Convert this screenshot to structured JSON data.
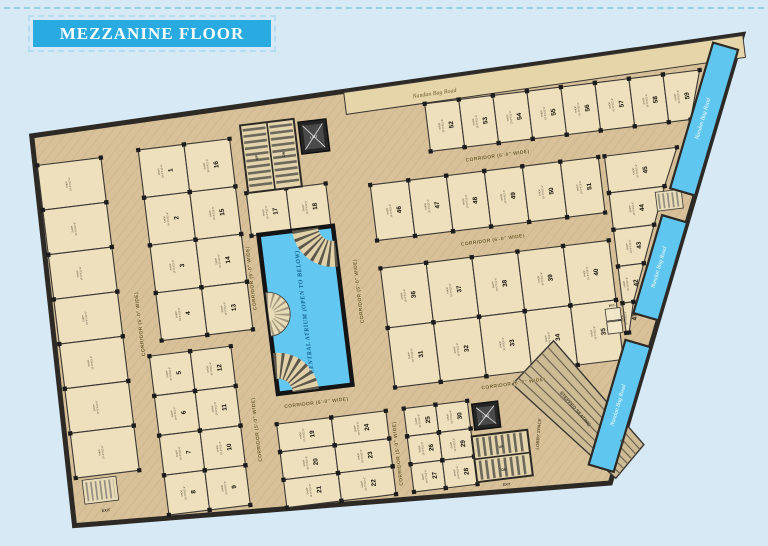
{
  "banner": {
    "title": "MEZZANINE FLOOR",
    "bg": "#29abe2"
  },
  "plan": {
    "colors": {
      "floor": "#d8c198",
      "shop": "#eee0bc",
      "wall": "#2d2a26",
      "water": "#62c8f2",
      "road": "#5fc6ef"
    },
    "atrium": {
      "label": "CENTRAL ATRIUM (OPEN TO BELOW)"
    },
    "roads": {
      "label": "Nandan Bag Road"
    },
    "stairs": {
      "up_label": "UP",
      "dn_label": "DN"
    },
    "lift_label": "LIFT",
    "wc_label": "W.C.",
    "shop_text": {
      "line1": "SHOP",
      "dims": "10'-0\"X12'-6\""
    },
    "corridors": [
      {
        "label": "CORRIDOR (6'-0\" WIDE)",
        "x": 460,
        "y": 92,
        "r": -1
      },
      {
        "label": "CORRIDOR (6'-0\" WIDE)",
        "x": 445,
        "y": 175,
        "r": -1
      },
      {
        "label": "CORRIDOR (6'-0\" WIDE)",
        "x": 448,
        "y": 320,
        "r": -1
      },
      {
        "label": "CORRIDOR (6'-0\" WIDE)",
        "x": 250,
        "y": 315,
        "r": 0
      },
      {
        "label": "CORRIDOR (6'-0\" WIDE)",
        "x": 307,
        "y": 208,
        "r": -90
      },
      {
        "label": "CORRIDOR (5'-0\" WIDE)",
        "x": 86,
        "y": 214,
        "r": -90
      },
      {
        "label": "CORRIDOR (6'-0\" WIDE)",
        "x": 202,
        "y": 182,
        "r": -90
      },
      {
        "label": "CORRIDOR (5'-0\" WIDE)",
        "x": 189,
        "y": 333,
        "r": -90
      },
      {
        "label": "CORRIDOR (5'-0\" WIDE)",
        "x": 326,
        "y": 374,
        "r": -90
      }
    ],
    "road_segments": [
      {
        "pts": "711.6,14.7 651.2,154.1 627.3,143.8 687.7,4.4",
        "lx": 669.6,
        "ly": 79.3,
        "r": -66.6
      },
      {
        "pts": "640.0,179.8 599.5,273.4 575.6,263.1 616.1,169.5",
        "lx": 607.9,
        "ly": 221.5,
        "r": -66.6
      },
      {
        "pts": "588.4,299.1 536.7,418.4 512.8,408.1 564.5,288.8",
        "lx": 550.6,
        "ly": 353.4,
        "r": -66.6
      }
    ],
    "misc_labels": [
      {
        "t": "LOBBY SPACE",
        "x": 468,
        "y": 372,
        "r": -78,
        "s": 4.4,
        "c": "#6b5b38",
        "i": 1
      },
      {
        "t": "STEPPED SEATING",
        "x": 505,
        "y": 352,
        "r": 56,
        "s": 4.8,
        "c": "#47402f",
        "i": 0
      },
      {
        "t": "Dn",
        "x": 548,
        "y": 390,
        "r": 56,
        "s": 3.6,
        "c": "#47402f",
        "i": 1
      },
      {
        "t": "EXIT",
        "x": 28,
        "y": 396,
        "r": 0,
        "s": 3.8,
        "c": "#3b3228",
        "i": 0
      },
      {
        "t": "EXIT",
        "x": 429,
        "y": 419,
        "r": 0,
        "s": 3.4,
        "c": "#3b3228",
        "i": 0
      }
    ],
    "shops": [
      {
        "x": 2,
        "y": 44,
        "w": 64,
        "h": 45
      },
      {
        "x": 2,
        "y": 89,
        "w": 64,
        "h": 45
      },
      {
        "x": 2,
        "y": 134,
        "w": 64,
        "h": 45
      },
      {
        "x": 2,
        "y": 179,
        "w": 64,
        "h": 45
      },
      {
        "x": 2,
        "y": 224,
        "w": 64,
        "h": 45
      },
      {
        "x": 2,
        "y": 269,
        "w": 64,
        "h": 45
      },
      {
        "x": 2,
        "y": 314,
        "w": 64,
        "h": 45
      },
      {
        "n": 1,
        "x": 104,
        "y": 41,
        "w": 46,
        "h": 48
      },
      {
        "n": 2,
        "x": 104,
        "y": 89,
        "w": 46,
        "h": 48
      },
      {
        "n": 3,
        "x": 104,
        "y": 137,
        "w": 46,
        "h": 48
      },
      {
        "n": 4,
        "x": 104,
        "y": 185,
        "w": 46,
        "h": 48
      },
      {
        "n": 16,
        "x": 150,
        "y": 41,
        "w": 46,
        "h": 48
      },
      {
        "n": 15,
        "x": 150,
        "y": 89,
        "w": 46,
        "h": 48
      },
      {
        "n": 14,
        "x": 150,
        "y": 137,
        "w": 46,
        "h": 48
      },
      {
        "n": 13,
        "x": 150,
        "y": 185,
        "w": 46,
        "h": 48
      },
      {
        "n": 5,
        "x": 90,
        "y": 247,
        "w": 41,
        "h": 40
      },
      {
        "n": 6,
        "x": 90,
        "y": 287,
        "w": 41,
        "h": 40
      },
      {
        "n": 7,
        "x": 90,
        "y": 327,
        "w": 41,
        "h": 40
      },
      {
        "n": 8,
        "x": 90,
        "y": 367,
        "w": 41,
        "h": 40
      },
      {
        "n": 12,
        "x": 131,
        "y": 247,
        "w": 41,
        "h": 40
      },
      {
        "n": 11,
        "x": 131,
        "y": 287,
        "w": 41,
        "h": 40
      },
      {
        "n": 10,
        "x": 131,
        "y": 327,
        "w": 41,
        "h": 40
      },
      {
        "n": 9,
        "x": 131,
        "y": 367,
        "w": 41,
        "h": 40
      },
      {
        "n": 17,
        "x": 206,
        "y": 97,
        "w": 40,
        "h": 43
      },
      {
        "n": 18,
        "x": 246,
        "y": 97,
        "w": 40,
        "h": 43
      },
      {
        "n": 19,
        "x": 208,
        "y": 330,
        "w": 55,
        "h": 28
      },
      {
        "n": 20,
        "x": 208,
        "y": 358,
        "w": 55,
        "h": 28
      },
      {
        "n": 21,
        "x": 208,
        "y": 386,
        "w": 55,
        "h": 28
      },
      {
        "n": 24,
        "x": 263,
        "y": 330,
        "w": 55,
        "h": 28
      },
      {
        "n": 23,
        "x": 263,
        "y": 358,
        "w": 55,
        "h": 28
      },
      {
        "n": 22,
        "x": 263,
        "y": 386,
        "w": 55,
        "h": 28
      },
      {
        "n": 25,
        "x": 336,
        "y": 330,
        "w": 32,
        "h": 28
      },
      {
        "n": 26,
        "x": 336,
        "y": 358,
        "w": 32,
        "h": 28
      },
      {
        "n": 27,
        "x": 336,
        "y": 386,
        "w": 32,
        "h": 28
      },
      {
        "n": 30,
        "x": 368,
        "y": 330,
        "w": 32,
        "h": 28
      },
      {
        "n": 29,
        "x": 368,
        "y": 358,
        "w": 32,
        "h": 28
      },
      {
        "n": 28,
        "x": 368,
        "y": 386,
        "w": 32,
        "h": 28
      },
      {
        "n": 36,
        "x": 330,
        "y": 188,
        "w": 46,
        "h": 60
      },
      {
        "n": 37,
        "x": 376,
        "y": 188,
        "w": 46,
        "h": 60
      },
      {
        "n": 38,
        "x": 422,
        "y": 188,
        "w": 46,
        "h": 60
      },
      {
        "n": 39,
        "x": 468,
        "y": 188,
        "w": 46,
        "h": 60
      },
      {
        "n": 40,
        "x": 514,
        "y": 188,
        "w": 46,
        "h": 60
      },
      {
        "n": 31,
        "x": 330,
        "y": 248,
        "w": 46,
        "h": 60
      },
      {
        "n": 32,
        "x": 376,
        "y": 248,
        "w": 46,
        "h": 60
      },
      {
        "n": 33,
        "x": 422,
        "y": 248,
        "w": 46,
        "h": 60
      },
      {
        "n": 34,
        "x": 468,
        "y": 248,
        "w": 46,
        "h": 60
      },
      {
        "n": 35,
        "x": 514,
        "y": 248,
        "w": 46,
        "h": 60
      },
      {
        "n": 46,
        "x": 330,
        "y": 104,
        "w": 38.3,
        "h": 56
      },
      {
        "n": 47,
        "x": 368.3,
        "y": 104,
        "w": 38.3,
        "h": 56
      },
      {
        "n": 48,
        "x": 406.6,
        "y": 104,
        "w": 38.3,
        "h": 56
      },
      {
        "n": 49,
        "x": 444.9,
        "y": 104,
        "w": 38.3,
        "h": 56
      },
      {
        "n": 50,
        "x": 483.2,
        "y": 104,
        "w": 38.3,
        "h": 56
      },
      {
        "n": 51,
        "x": 521.5,
        "y": 104,
        "w": 38.3,
        "h": 56
      },
      {
        "n": 45,
        "pts": "566,104 639,104 622,141 566,141"
      },
      {
        "n": 44,
        "pts": "566,141 622,141 607,178 566,178"
      },
      {
        "n": 43,
        "pts": "566,178 607,178 592,215 566,215"
      },
      {
        "n": 42,
        "pts": "566,215 592,215 577,252 566,252"
      },
      {
        "n": 41,
        "pts": "566,252 577,252 569,282 566,282"
      },
      {
        "n": 52,
        "x": 394,
        "y": 30,
        "w": 34.3,
        "h": 48
      },
      {
        "n": 53,
        "x": 428.3,
        "y": 30,
        "w": 34.3,
        "h": 48
      },
      {
        "n": 54,
        "x": 462.6,
        "y": 30,
        "w": 34.3,
        "h": 48
      },
      {
        "n": 55,
        "x": 496.9,
        "y": 30,
        "w": 34.3,
        "h": 48
      },
      {
        "n": 56,
        "x": 531.1,
        "y": 30,
        "w": 34.3,
        "h": 48
      },
      {
        "n": 57,
        "x": 565.4,
        "y": 30,
        "w": 34.3,
        "h": 48
      },
      {
        "n": 58,
        "x": 599.7,
        "y": 30,
        "w": 34.3,
        "h": 48
      },
      {
        "n": 59,
        "pts": "634,30 671,30 656,78 634,78"
      }
    ]
  }
}
